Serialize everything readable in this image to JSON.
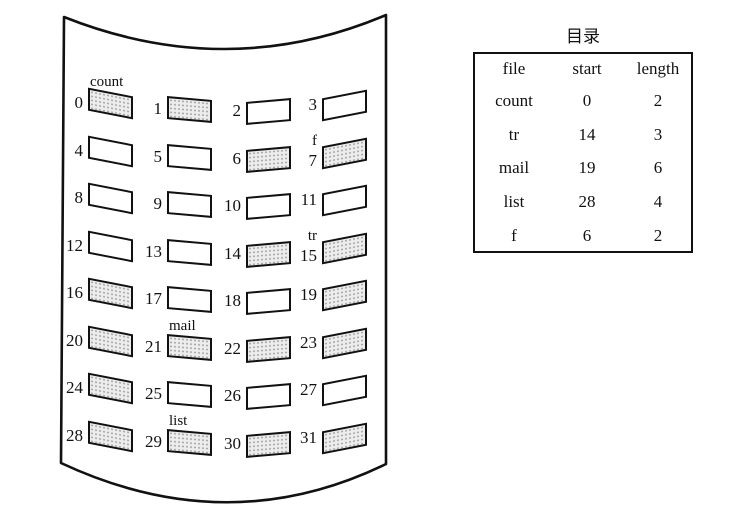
{
  "figure": {
    "description_labels": {
      "count": "count",
      "f": "f",
      "tr": "tr",
      "mail": "mail",
      "list": "list"
    }
  },
  "disk": {
    "blocks": [
      {
        "num": "0",
        "shaded": true,
        "label_above": "count"
      },
      {
        "num": "1",
        "shaded": true
      },
      {
        "num": "2",
        "shaded": false
      },
      {
        "num": "3",
        "shaded": false
      },
      {
        "num": "4",
        "shaded": false
      },
      {
        "num": "5",
        "shaded": false
      },
      {
        "num": "6",
        "shaded": true
      },
      {
        "num": "7",
        "shaded": true,
        "num_label": "f"
      },
      {
        "num": "8",
        "shaded": false
      },
      {
        "num": "9",
        "shaded": false
      },
      {
        "num": "10",
        "shaded": false
      },
      {
        "num": "11",
        "shaded": false
      },
      {
        "num": "12",
        "shaded": false
      },
      {
        "num": "13",
        "shaded": false
      },
      {
        "num": "14",
        "shaded": true
      },
      {
        "num": "15",
        "shaded": true,
        "num_label": "tr"
      },
      {
        "num": "16",
        "shaded": true
      },
      {
        "num": "17",
        "shaded": false
      },
      {
        "num": "18",
        "shaded": false
      },
      {
        "num": "19",
        "shaded": true
      },
      {
        "num": "20",
        "shaded": true
      },
      {
        "num": "21",
        "shaded": true,
        "label_above": "mail"
      },
      {
        "num": "22",
        "shaded": true
      },
      {
        "num": "23",
        "shaded": true
      },
      {
        "num": "24",
        "shaded": true
      },
      {
        "num": "25",
        "shaded": false
      },
      {
        "num": "26",
        "shaded": false
      },
      {
        "num": "27",
        "shaded": false
      },
      {
        "num": "28",
        "shaded": true
      },
      {
        "num": "29",
        "shaded": true,
        "label_above": "list"
      },
      {
        "num": "30",
        "shaded": true
      },
      {
        "num": "31",
        "shaded": true
      }
    ]
  },
  "directory_table": {
    "title": "目录",
    "columns": [
      "file",
      "start",
      "length"
    ],
    "rows": [
      [
        "count",
        "0",
        "2"
      ],
      [
        "tr",
        "14",
        "3"
      ],
      [
        "mail",
        "19",
        "6"
      ],
      [
        "list",
        "28",
        "4"
      ],
      [
        "f",
        "6",
        "2"
      ]
    ]
  },
  "colors": {
    "ink": "#111111",
    "shaded_block_fill": "#ededed",
    "background": "#ffffff"
  }
}
